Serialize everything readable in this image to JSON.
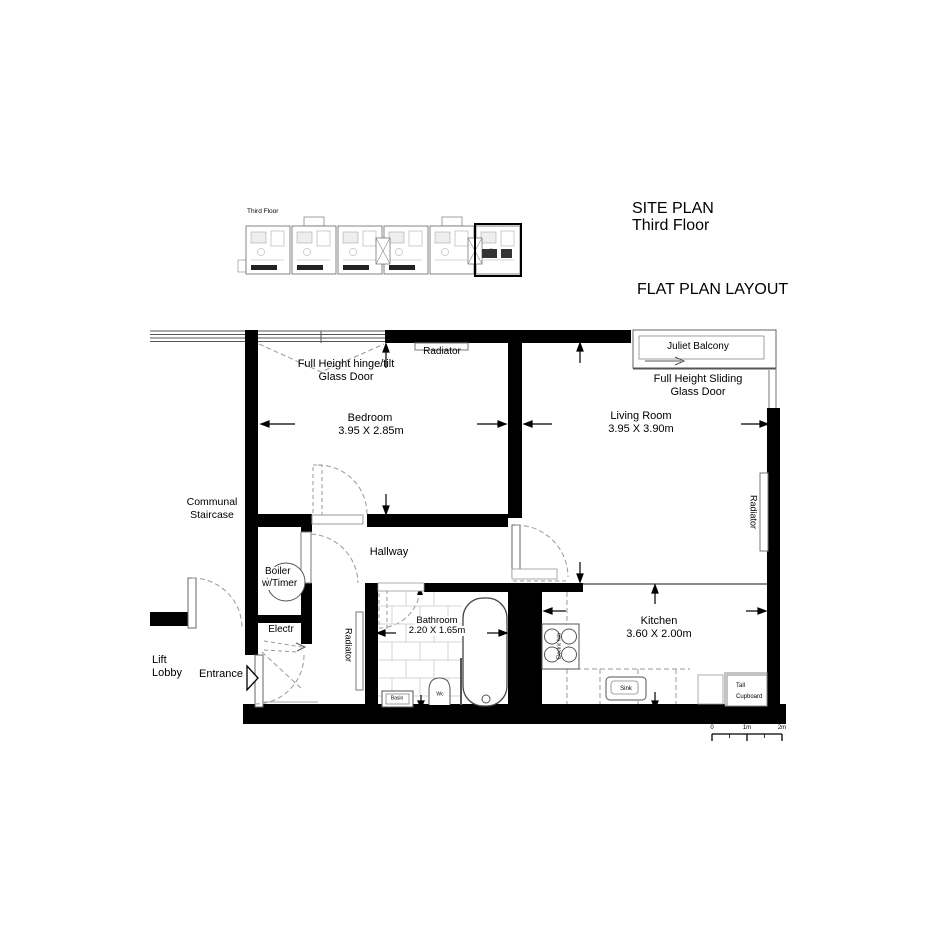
{
  "header": {
    "site_plan_title": "SITE PLAN",
    "site_plan_subtitle": "Third Floor",
    "flat_plan_title": "FLAT PLAN LAYOUT"
  },
  "site_plan_thumb": {
    "label": "Third Floor"
  },
  "rooms": {
    "bedroom": {
      "name": "Bedroom",
      "dims": "3.95 X 2.85m"
    },
    "living_room": {
      "name": "Living Room",
      "dims": "3.95 X 3.90m"
    },
    "kitchen": {
      "name": "Kitchen",
      "dims": "3.60 X 2.00m"
    },
    "bathroom": {
      "name": "Bathroom",
      "dims": "2.20 X 1.65m"
    },
    "hallway": {
      "name": "Hallway"
    }
  },
  "features": {
    "hinge_door_line1": "Full Height hinge/tilt",
    "hinge_door_line2": "Glass Door",
    "sliding_door_line1": "Full Height Sliding",
    "sliding_door_line2": "Glass Door",
    "juliet_balcony": "Juliet Balcony",
    "radiator_top": "Radiator",
    "radiator_living": "Radiator",
    "radiator_bathroom": "Radiator",
    "communal_line1": "Communal",
    "communal_line2": "Staircase",
    "boiler_line1": "Boiler",
    "boiler_line2": "w/Timer",
    "electr": "Electr",
    "lift_line1": "Lift",
    "lift_line2": "Lobby",
    "entrance": "Entrance",
    "electric_hob": "Electric hob",
    "sink": "Sink",
    "basin": "Basin",
    "wc": "Wc",
    "tall_cupboard_line1": "Tall",
    "tall_cupboard_line2": "Cupboard"
  },
  "scale_bar": {
    "start": "0",
    "mid": "1m",
    "end": "2m"
  },
  "colors": {
    "wall": "#000000",
    "thin_line": "#444444",
    "dashed": "#999999",
    "tile": "#c8c8c8"
  }
}
